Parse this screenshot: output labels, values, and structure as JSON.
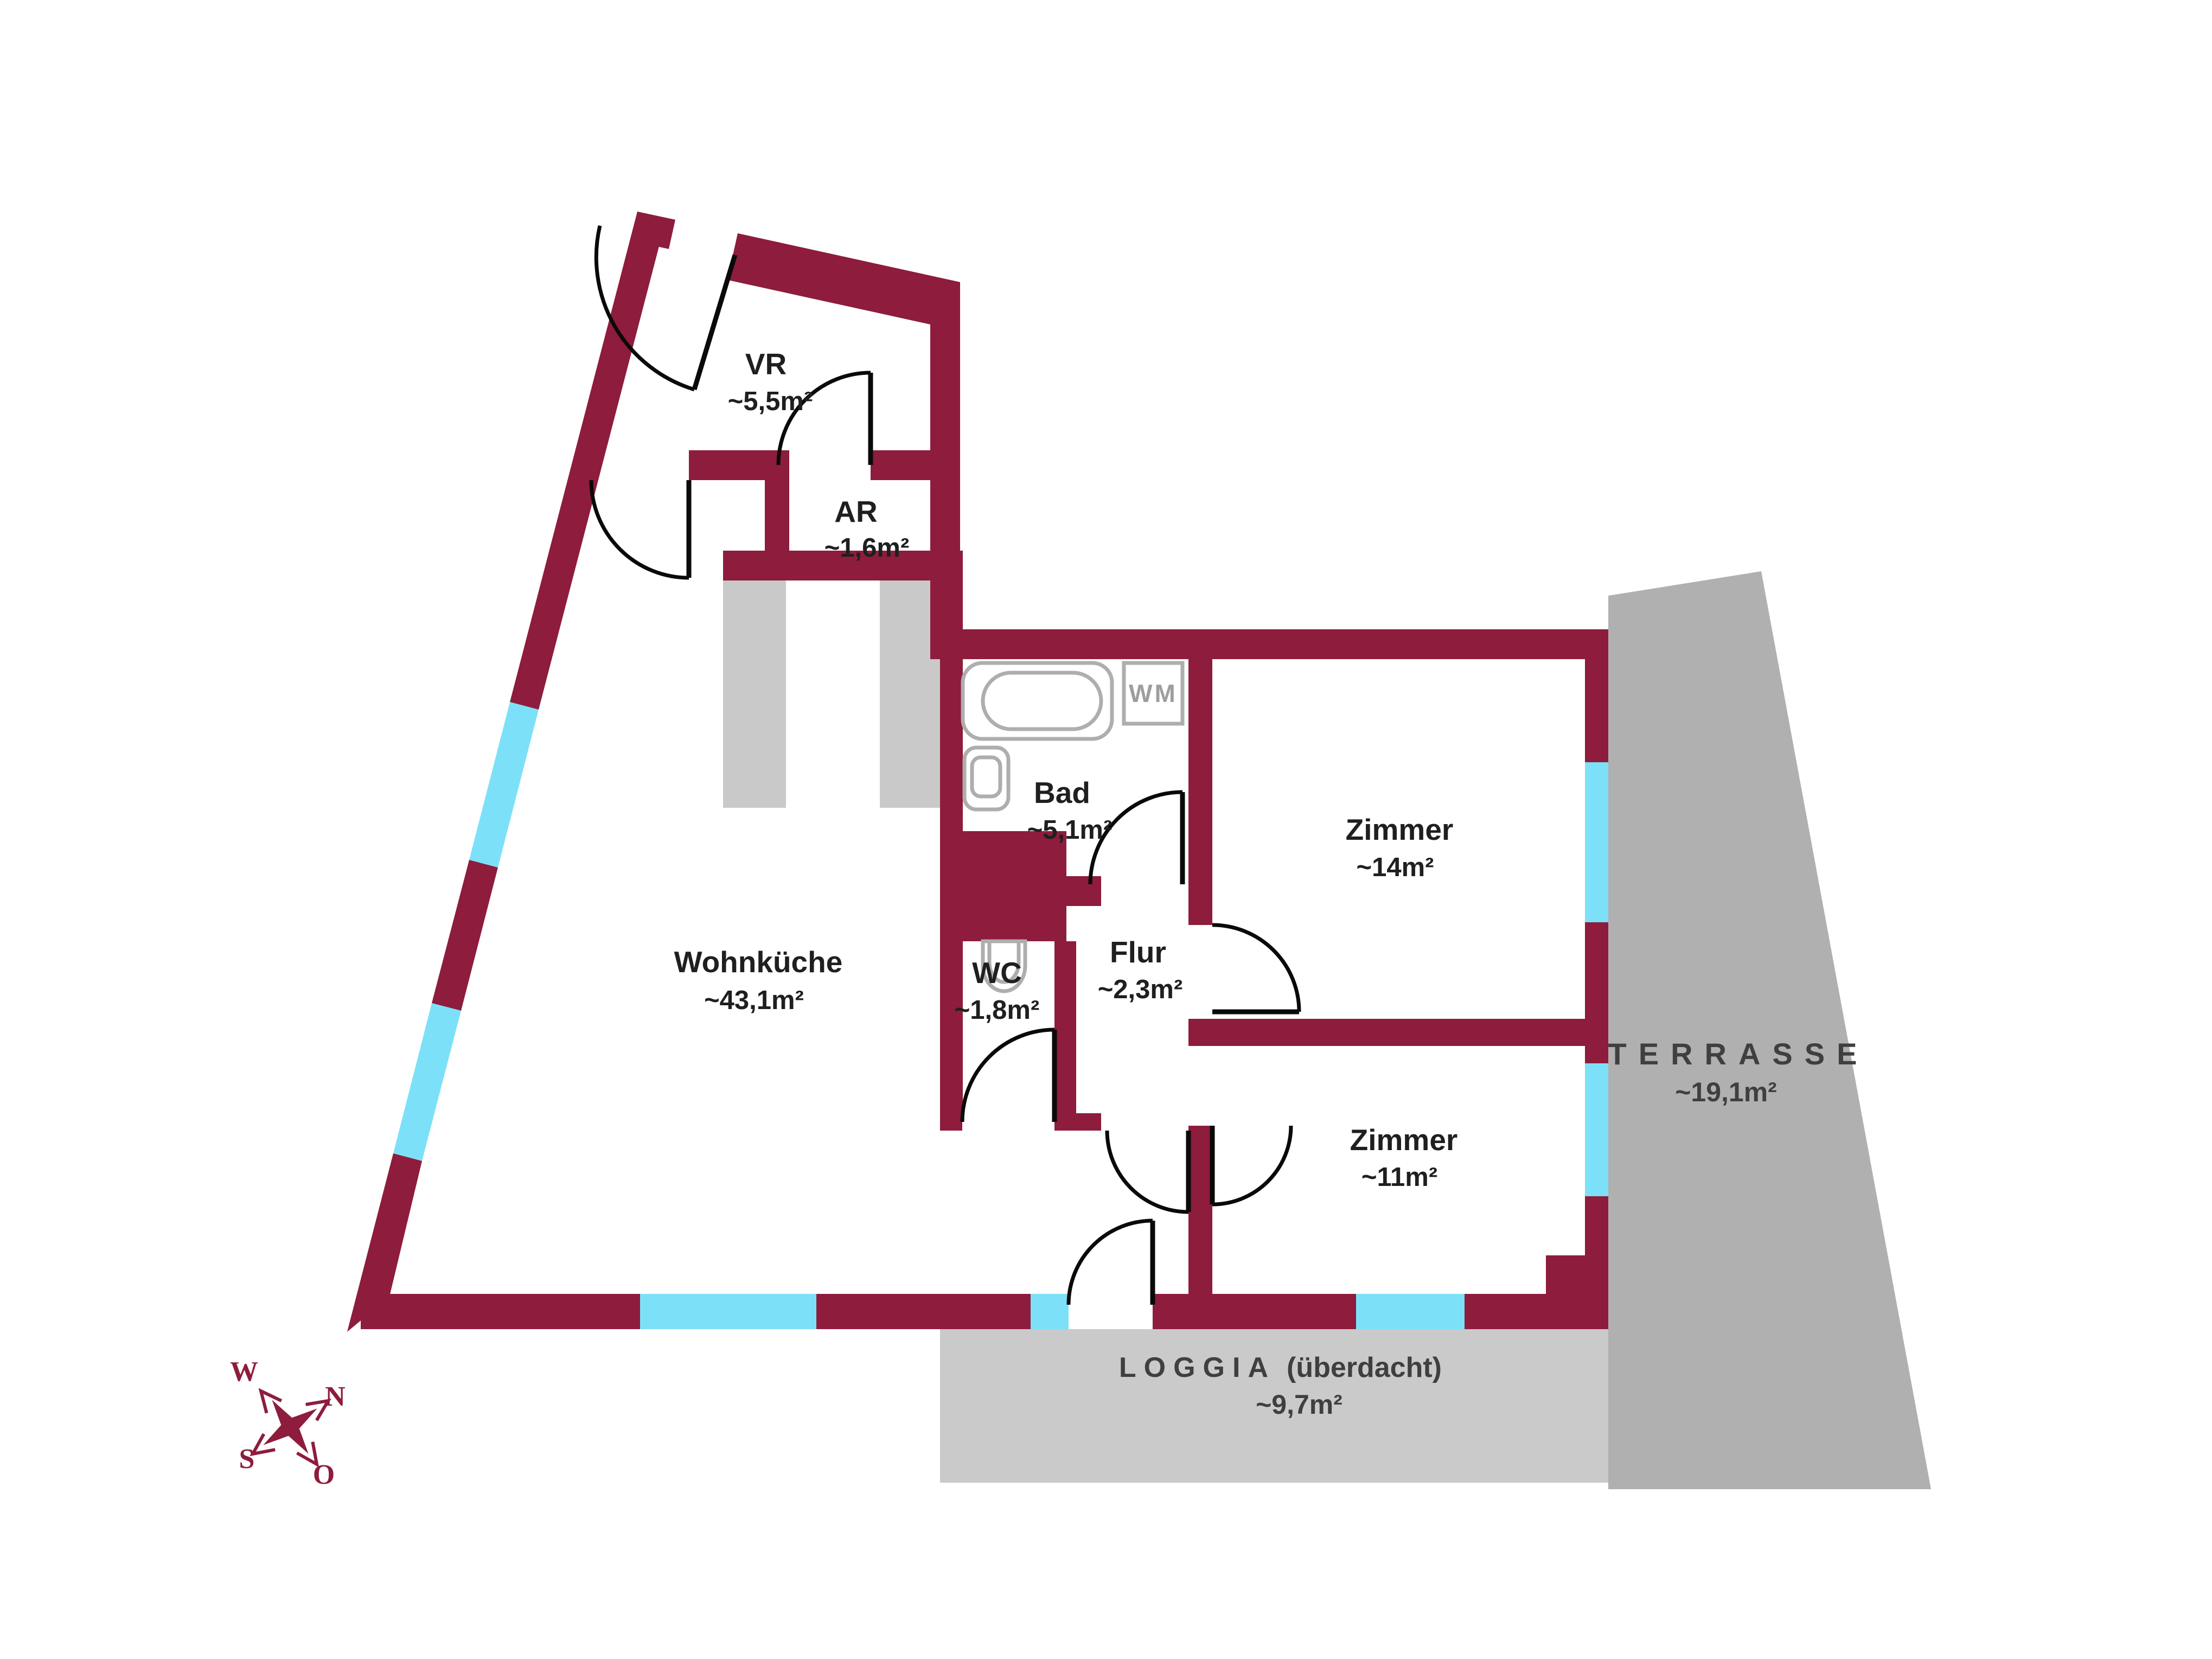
{
  "plan": {
    "colors": {
      "wall": "#8e1c3c",
      "window": "#7ce1f8",
      "terrace": "#b0b0b0",
      "loggia": "#cacaca",
      "shaft": "#c9c9c9",
      "fixture": "#aeaeae",
      "label": "#1f1f1f",
      "outdoor_label": "#3f3f3f",
      "wm_label": "#9e9e9e"
    },
    "rooms": {
      "vr": {
        "label": "VR",
        "area": "~5,5m²"
      },
      "ar": {
        "label": "AR",
        "area": "~1,6m²"
      },
      "bad": {
        "label": "Bad",
        "area": "~5,1m²"
      },
      "wc": {
        "label": "WC",
        "area": "~1,8m²"
      },
      "flur": {
        "label": "Flur",
        "area": "~2,3m²"
      },
      "zimmer14": {
        "label": "Zimmer",
        "area": "~14m²"
      },
      "zimmer11": {
        "label": "Zimmer",
        "area": "~11m²"
      },
      "wohnkueche": {
        "label": "Wohnküche",
        "area": "~43,1m²"
      }
    },
    "outdoor": {
      "terrasse": {
        "label": "TERRASSE",
        "area": "~19,1m²"
      },
      "loggia": {
        "label": "LOGGIA",
        "suffix": "(überdacht)",
        "area": "~9,7m²"
      }
    },
    "fixtures": {
      "washing_machine": "WM"
    },
    "compass": {
      "north": "N",
      "south": "S",
      "west": "W",
      "east": "O"
    }
  }
}
